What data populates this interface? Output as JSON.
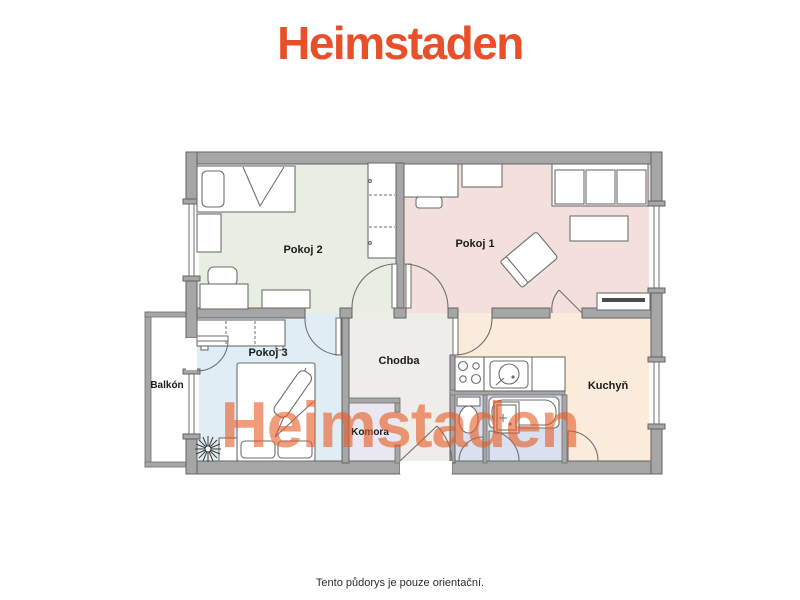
{
  "brand": {
    "logo_text": "Heimstaden",
    "logo_color": "#e8502a"
  },
  "watermark": {
    "text": "Heimstaden",
    "color": "rgba(231,90,34,0.6)"
  },
  "footer": {
    "disclaimer": "Tento půdorys je pouze orientační."
  },
  "floorplan": {
    "wall_color": "#a6a6a6",
    "rooms": {
      "pokoj2": {
        "label": "Pokoj 2",
        "floor_color": "#e8eee1"
      },
      "pokoj1": {
        "label": "Pokoj 1",
        "floor_color": "#f3e0dd"
      },
      "pokoj3": {
        "label": "Pokoj 3",
        "floor_color": "#e0edf5"
      },
      "chodba": {
        "label": "Chodba",
        "floor_color": "#eeedea"
      },
      "komora": {
        "label": "Komora",
        "floor_color": "#e9e7f1"
      },
      "kuchyn": {
        "label": "Kuchyň",
        "floor_color": "#fbebdb"
      },
      "balkon": {
        "label": "Balkón",
        "floor_color": "#ffffff"
      },
      "koupelna": {
        "floor_color": "#d9e1f0"
      }
    }
  }
}
